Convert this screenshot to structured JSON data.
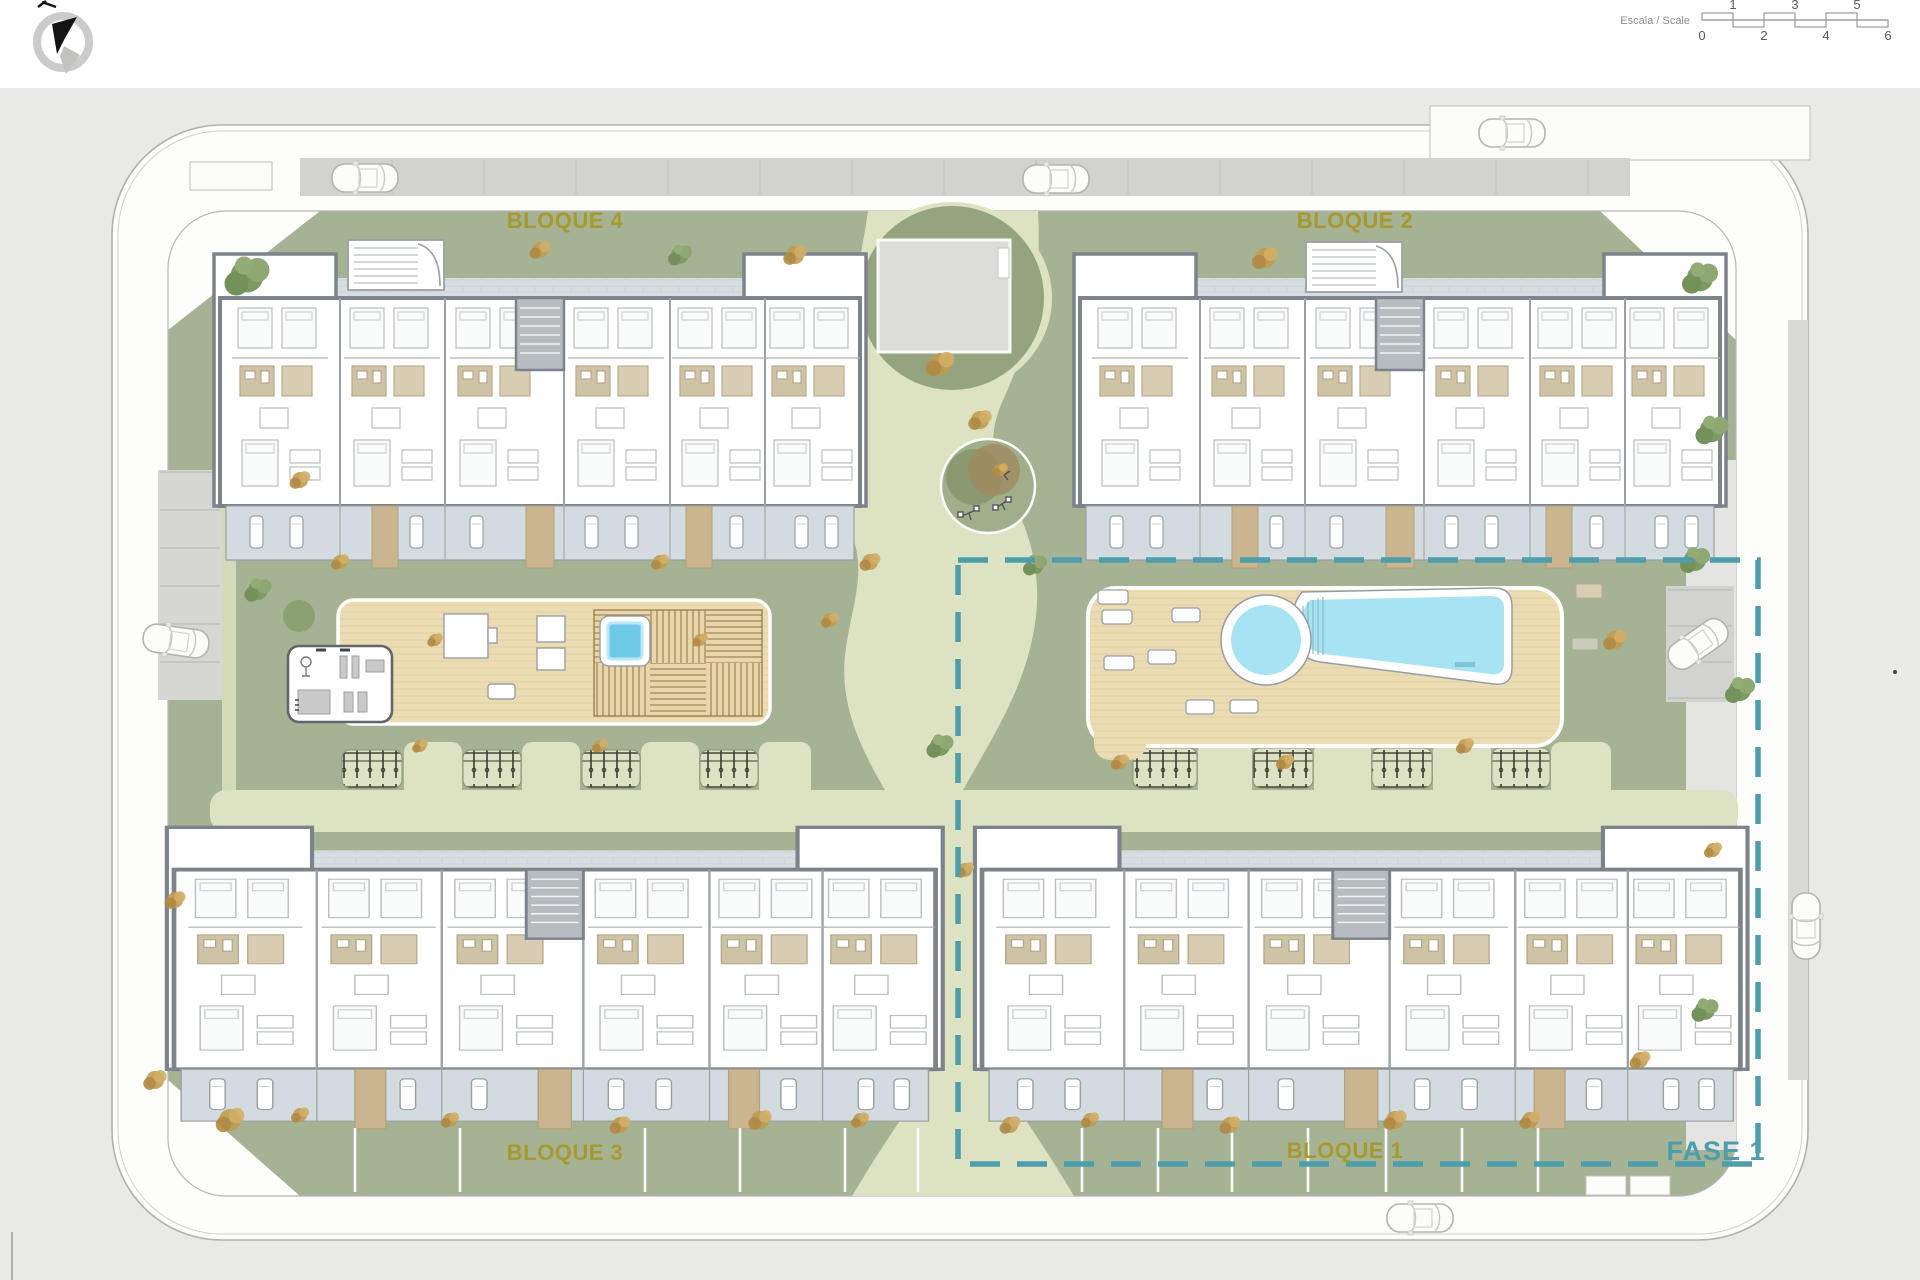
{
  "plan": {
    "title": "Residential site plan",
    "phase_label": "FASE 1",
    "blocks": {
      "bloque1": "BLOQUE 1",
      "bloque2": "BLOQUE 2",
      "bloque3": "BLOQUE 3",
      "bloque4": "BLOQUE 4"
    }
  },
  "scale_bar": {
    "caption": "Escala / Scale",
    "top_numbers": [
      "1",
      "3",
      "5"
    ],
    "bottom_numbers": [
      "0",
      "2",
      "4",
      "6"
    ]
  },
  "icons": {
    "compass": "north-arrow-compass",
    "pool": "swimming-pool",
    "playground": "playground-circle"
  },
  "colors": {
    "label_gold": "#a6992e",
    "phase_teal": "#4d9dab",
    "lawn_green": "#a6b294",
    "path_pale": "#dde3c2",
    "pool_blue": "#a7e4f3",
    "deck_tan": "#ecdcb4",
    "terrace_gray": "#d2dbdf",
    "road_white": "#fdfdfc",
    "parking_gray": "#d2d3d0"
  }
}
